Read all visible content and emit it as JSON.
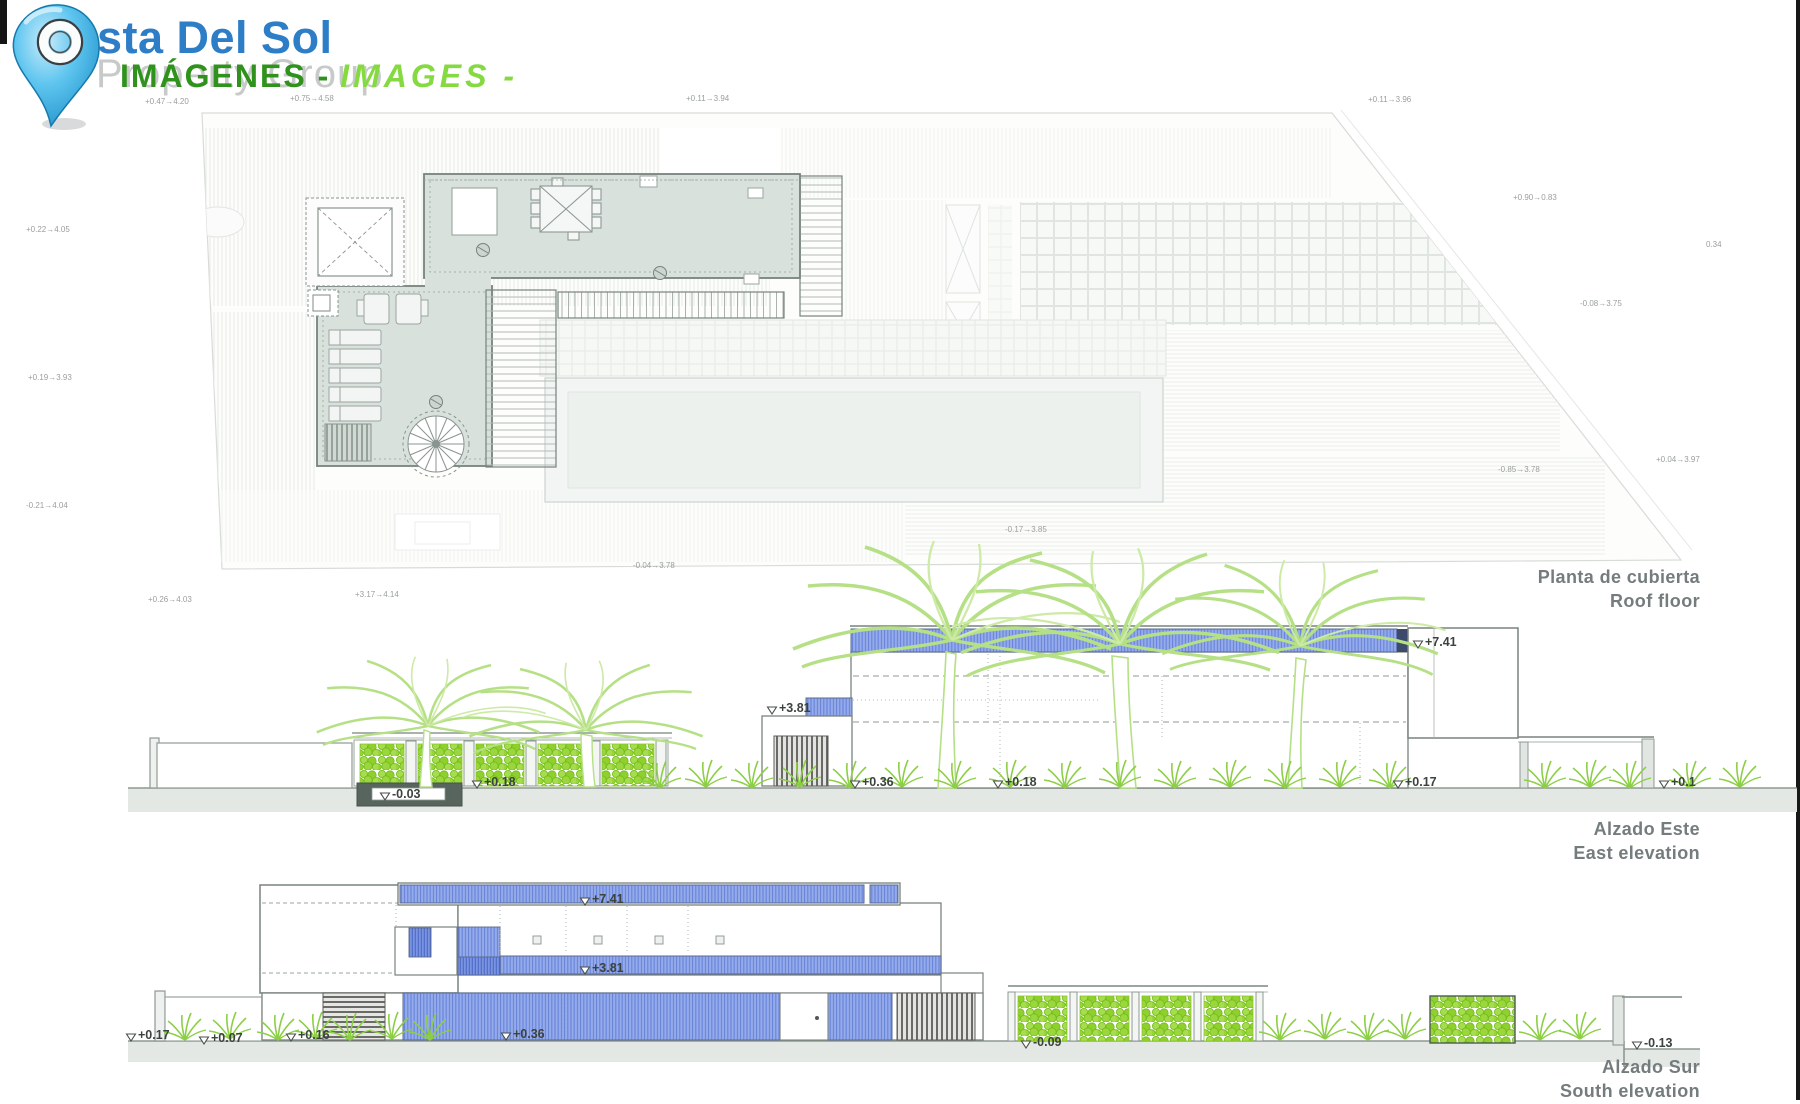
{
  "header": {
    "brand_name": "Costa Del Sol",
    "brand_subtitle": "Property Group",
    "title_es": "IMÁGENES -",
    "title_en": "IMAGES -"
  },
  "palette": {
    "brand": "#2d7ec7",
    "subtitle": "#c7cac8",
    "title-es": "#2f921c",
    "title-en": "#84da40",
    "pin-blue": "#45b6e8",
    "terrace": "#d9e1dc",
    "ground": "#e4e8e5",
    "blue-fill": "#92a8e8",
    "blue-line": "#6383da",
    "hedge": "#96d437",
    "palm": "#b5e085",
    "grass": "#8ccf45",
    "louver": "#57564f",
    "ink": "#3c423e",
    "dim": "#9aa09a",
    "label": "#757c7e"
  },
  "drawings": {
    "roof": {
      "label_es": "Planta de cubierta",
      "label_en": "Roof floor",
      "markers": [],
      "dims": [
        {
          "text": "+0.47→4.20",
          "x": 145,
          "y": 104
        },
        {
          "text": "+0.75→4.58",
          "x": 290,
          "y": 101
        },
        {
          "text": "+0.11→3.94",
          "x": 686,
          "y": 101
        },
        {
          "text": "+0.11→3.96",
          "x": 1368,
          "y": 102
        },
        {
          "text": "+0.90→0.83",
          "x": 1513,
          "y": 200
        },
        {
          "text": "0.34",
          "x": 1706,
          "y": 247
        },
        {
          "text": "-0.08→3.75",
          "x": 1580,
          "y": 306
        },
        {
          "text": "+0.04→3.97",
          "x": 1656,
          "y": 462
        },
        {
          "text": "-0.85→3.78",
          "x": 1498,
          "y": 472
        },
        {
          "text": "+0.22→4.05",
          "x": 26,
          "y": 232
        },
        {
          "text": "+0.19→3.93",
          "x": 28,
          "y": 380
        },
        {
          "text": "-0.21→4.04",
          "x": 26,
          "y": 508
        },
        {
          "text": "+0.26→4.03",
          "x": 148,
          "y": 602
        },
        {
          "text": "+3.17→4.14",
          "x": 355,
          "y": 597
        },
        {
          "text": "-0.04→3.78",
          "x": 633,
          "y": 568
        },
        {
          "text": "-0.17→3.85",
          "x": 1005,
          "y": 532
        }
      ]
    },
    "east": {
      "label_es": "Alzado Este",
      "label_en": "East elevation",
      "markers": [
        {
          "text": "+7.41",
          "x": 1418,
          "y": 648
        },
        {
          "text": "+3.81",
          "x": 772,
          "y": 714
        },
        {
          "text": "-0.03",
          "x": 385,
          "y": 800
        },
        {
          "text": "+0.18",
          "x": 477,
          "y": 788
        },
        {
          "text": "+0.36",
          "x": 855,
          "y": 788
        },
        {
          "text": "+0.18",
          "x": 998,
          "y": 788
        },
        {
          "text": "+0.17",
          "x": 1398,
          "y": 788
        },
        {
          "text": "+0.1",
          "x": 1664,
          "y": 788
        }
      ],
      "dims": []
    },
    "south": {
      "label_es": "Alzado Sur",
      "label_en": "South elevation",
      "markers": [
        {
          "text": "+7.41",
          "x": 585,
          "y": 905
        },
        {
          "text": "+3.81",
          "x": 585,
          "y": 974
        },
        {
          "text": "+0.17",
          "x": 131,
          "y": 1041
        },
        {
          "text": "+0.07",
          "x": 204,
          "y": 1044
        },
        {
          "text": "+0.16",
          "x": 291,
          "y": 1041
        },
        {
          "text": "+0.36",
          "x": 506,
          "y": 1040
        },
        {
          "text": "-0.09",
          "x": 1026,
          "y": 1048
        },
        {
          "text": "-0.13",
          "x": 1637,
          "y": 1049
        }
      ],
      "dims": []
    }
  }
}
